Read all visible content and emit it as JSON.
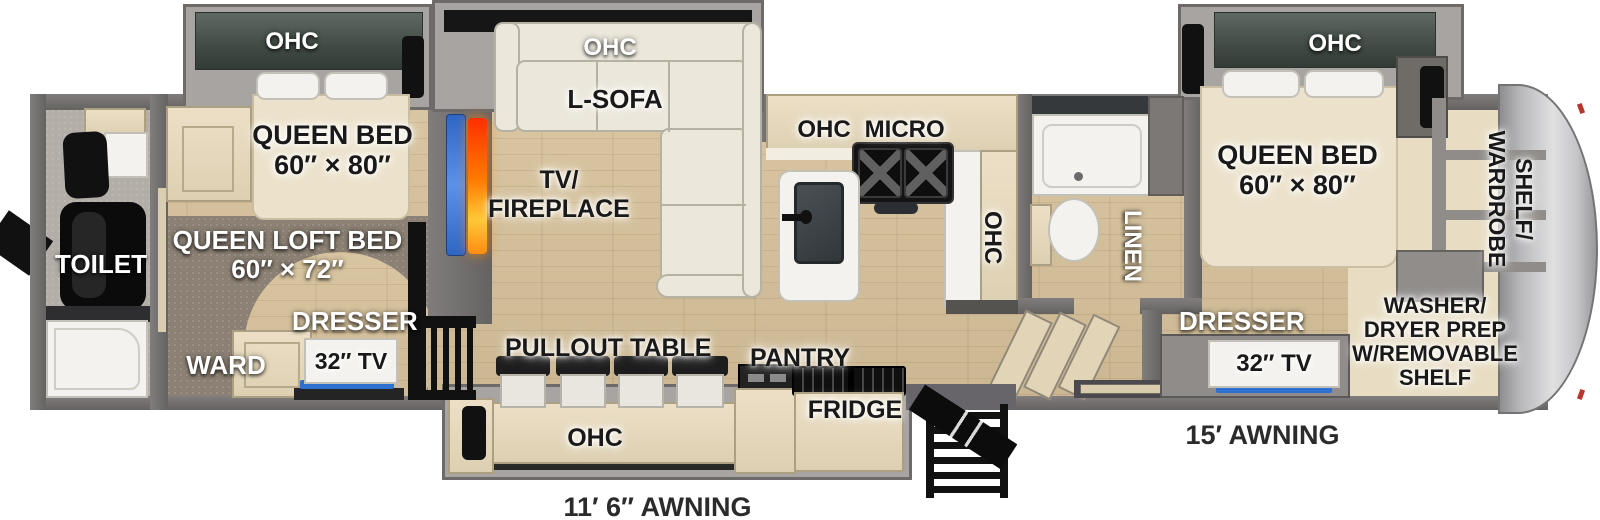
{
  "colors": {
    "floor_wood": "#d6c19a",
    "carpet_brown": "#8c8174",
    "wall_gray": "#6d6a69",
    "slide_gray": "#a7a4a1",
    "overhead_cabinet_green": "#47524c",
    "cabinet_cream": "#e6dabf",
    "fixture_white": "#f3f2ee",
    "tv_blue": "#2e6fd2",
    "fireplace_orange": "#ff7a00",
    "accent_black": "#111111"
  },
  "labels": {
    "rear_bath": {
      "toilet": "TOILET"
    },
    "bunk_room": {
      "ohc": "OHC",
      "bed_line1": "QUEEN BED",
      "bed_line2": "60″ × 80″",
      "loft_line1": "QUEEN LOFT BED",
      "loft_line2": "60″ × 72″",
      "dresser": "DRESSER",
      "tv": "32″ TV",
      "ward": "WARD"
    },
    "living": {
      "ohc": "OHC",
      "sofa": "L-SOFA",
      "tv_line1": "TV/",
      "tv_line2": "FIREPLACE"
    },
    "kitchen": {
      "ohc": "OHC",
      "micro": "MICRO",
      "ohc_vertical": "OHC"
    },
    "mid_bath": {
      "linen": "LINEN"
    },
    "dinette": {
      "pullout_table": "PULLOUT TABLE",
      "ohc": "OHC",
      "pantry": "PANTRY",
      "fridge": "FRIDGE"
    },
    "front_bedroom": {
      "ohc": "OHC",
      "bed_line1": "QUEEN BED",
      "bed_line2": "60″ × 80″",
      "dresser": "DRESSER",
      "tv": "32″ TV"
    },
    "front_closet": {
      "shelf_line1": "SHELF/",
      "shelf_line2": "WARDROBE",
      "washer_line1": "WASHER/",
      "washer_line2": "DRYER PREP",
      "washer_line3": "W/REMOVABLE",
      "washer_line4": "SHELF"
    },
    "awnings": {
      "main": "11′ 6″ AWNING",
      "front": "15′ AWNING"
    }
  }
}
